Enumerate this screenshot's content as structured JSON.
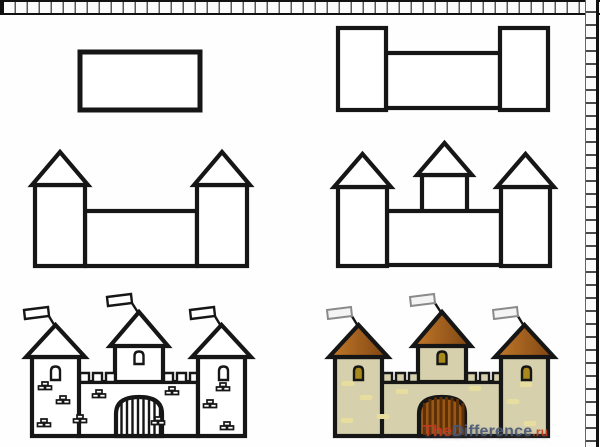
{
  "watermark": {
    "the": "The",
    "difference": "Difference",
    "tld": ".ru"
  },
  "colors": {
    "ink": "#161616",
    "paper": "#ffffff",
    "grid_line": "#111111",
    "grid_divider": "#555555",
    "roof_light": "#c4792a",
    "roof_dark": "#7d4512",
    "wall": "#d6d1ac",
    "gate": "#9a5716",
    "gate_bar": "#5e3008",
    "window": "#a8891c",
    "flag": "#f4f4f4",
    "brick_spot": "#e7dd9e",
    "watermark_red": "#c63a1e",
    "watermark_blue": "#4a5878"
  },
  "panels": [
    "step-1-base-rectangle",
    "step-2-two-towers",
    "step-3-tower-roofs",
    "step-4-center-tower",
    "step-5-outline-castle",
    "step-6-colored-castle"
  ]
}
